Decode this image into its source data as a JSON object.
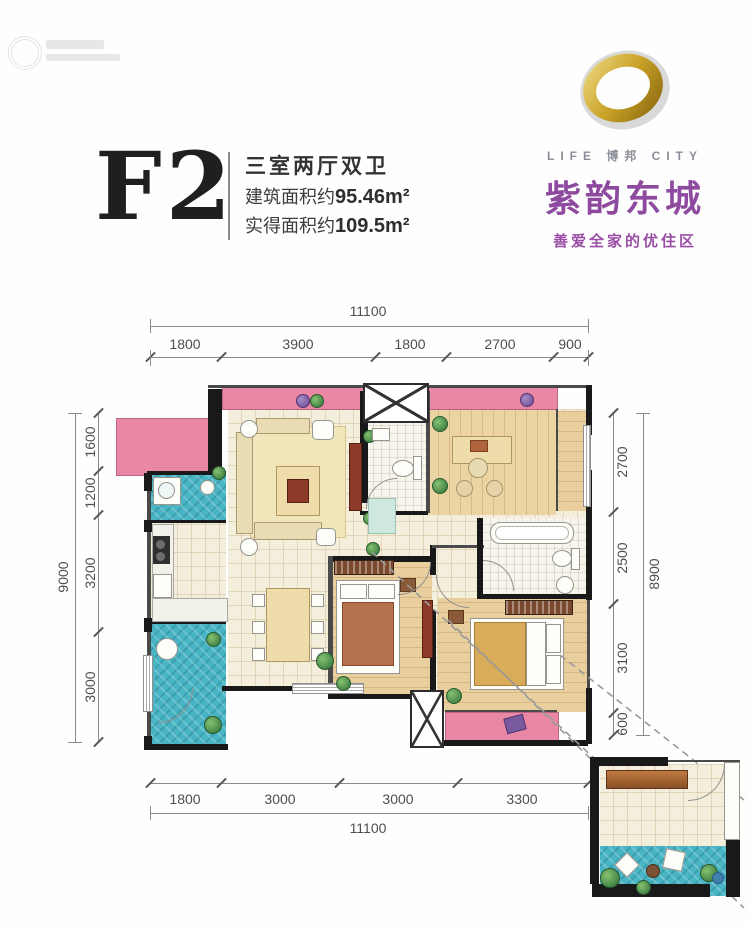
{
  "header": {
    "plan_code": "F2",
    "layout": "三室两厅双卫",
    "area1_label": "建筑面积约",
    "area1_value": "95.46m²",
    "area2_label": "实得面积约",
    "area2_value": "109.5m²"
  },
  "brand": {
    "life_city": "LIFE 博邦 CITY",
    "name": "紫韵东城",
    "tagline": "善爱全家的优住区"
  },
  "dimensions": {
    "top": {
      "total": "11100",
      "segments": [
        "1800",
        "3900",
        "1800",
        "2700",
        "900"
      ]
    },
    "bottom": {
      "total": "11100",
      "segments": [
        "1800",
        "3000",
        "3000",
        "3300"
      ]
    },
    "left": {
      "total": "9000",
      "segments": [
        "1600",
        "1200",
        "3200",
        "3000"
      ]
    },
    "right": {
      "total": "8900",
      "segments": [
        "2700",
        "2500",
        "3100",
        "600"
      ]
    }
  },
  "colors": {
    "balcony_pink": "#e987a4",
    "tile_teal": "#49b4c4",
    "floor_beige": "#f4eedc",
    "floor_wood": "#ecd3a2",
    "wall_black": "#191919",
    "brand_purple": "#8e4a9e",
    "brand_gold": "#c9a227",
    "dim_gray": "#555555"
  }
}
